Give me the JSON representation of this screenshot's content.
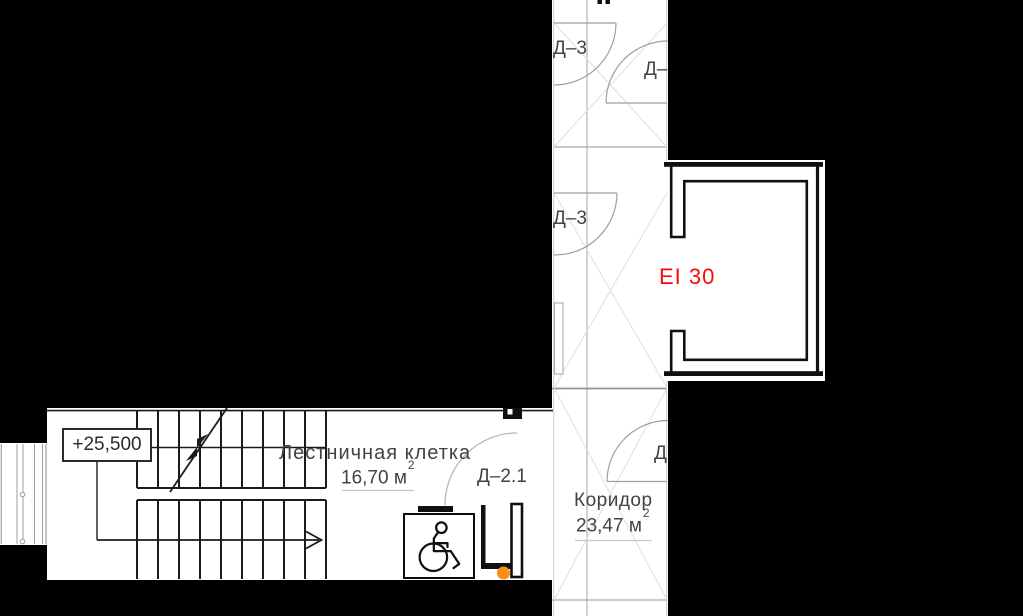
{
  "colors": {
    "background": "#000000",
    "paper": "#FFFFFF",
    "line_dark": "#1B1B1B",
    "line_gray": "#A8ACAE",
    "line_faint": "#DCDFE0",
    "text": "#3E4347",
    "fire_rating_red": "#F70A0A",
    "marker_orange": "#F9901A"
  },
  "elevation_marker": {
    "label": "+25,500"
  },
  "fire_rating": {
    "label": "EI 30"
  },
  "rooms": {
    "staircase": {
      "name": "Лестничная клетка",
      "area": "16,70 м",
      "area_sup": "2"
    },
    "corridor": {
      "name": "Коридор",
      "area": "23,47 м",
      "area_sup": "2"
    }
  },
  "doors": {
    "top_left": "Д–3",
    "top_right_cut": "Д–",
    "middle": "Д–3",
    "staircase": "Д–2.1",
    "corridor_cut": "Д"
  }
}
